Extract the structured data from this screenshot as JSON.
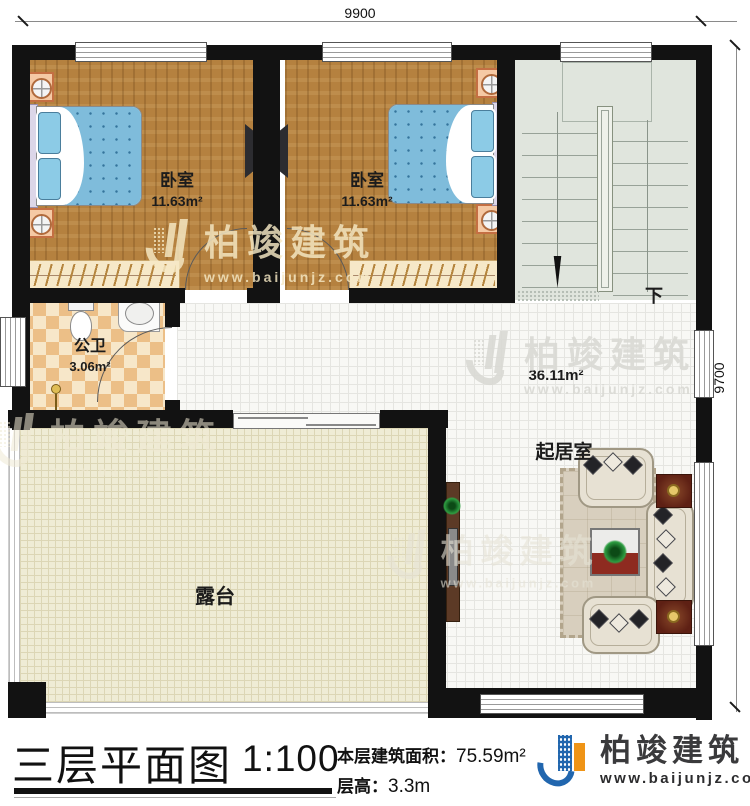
{
  "plan": {
    "dim_top": "9900",
    "dim_right": "9700",
    "rooms": {
      "bedroom_left": {
        "name": "卧室",
        "area": "11.63m²"
      },
      "bedroom_right": {
        "name": "卧室",
        "area": "11.63m²"
      },
      "bathroom": {
        "name": "公卫",
        "area": "3.06m²"
      },
      "living_room": {
        "name": "起居室",
        "area": "36.11m²"
      },
      "terrace": {
        "name": "露台"
      },
      "stairs": {
        "direction_label": "下"
      }
    }
  },
  "watermark": {
    "brand": "柏竣建筑",
    "url": "www.baijunjz.com"
  },
  "footer": {
    "title": "三层平面图",
    "scale": "1:100",
    "area_label": "本层建筑面积：",
    "area_value": "75.59m²",
    "floor_height_label": "层高：",
    "floor_height_value": "3.3m",
    "logo_brand": "柏竣建筑",
    "logo_url": "www.baijunjz.com"
  },
  "colors": {
    "wall": "#121212",
    "wood_floor": "#b5813f",
    "stair_floor": "#e0e5dd",
    "tile_floor": "#f8f8f5",
    "terrace_floor": "#efecd5",
    "bath_tile_dark": "#ecbf87",
    "bath_tile_light": "#f7e7c9",
    "bed_blue": "#7fbcdb",
    "logo_blue": "#2166ae",
    "logo_orange": "#ef9416"
  }
}
